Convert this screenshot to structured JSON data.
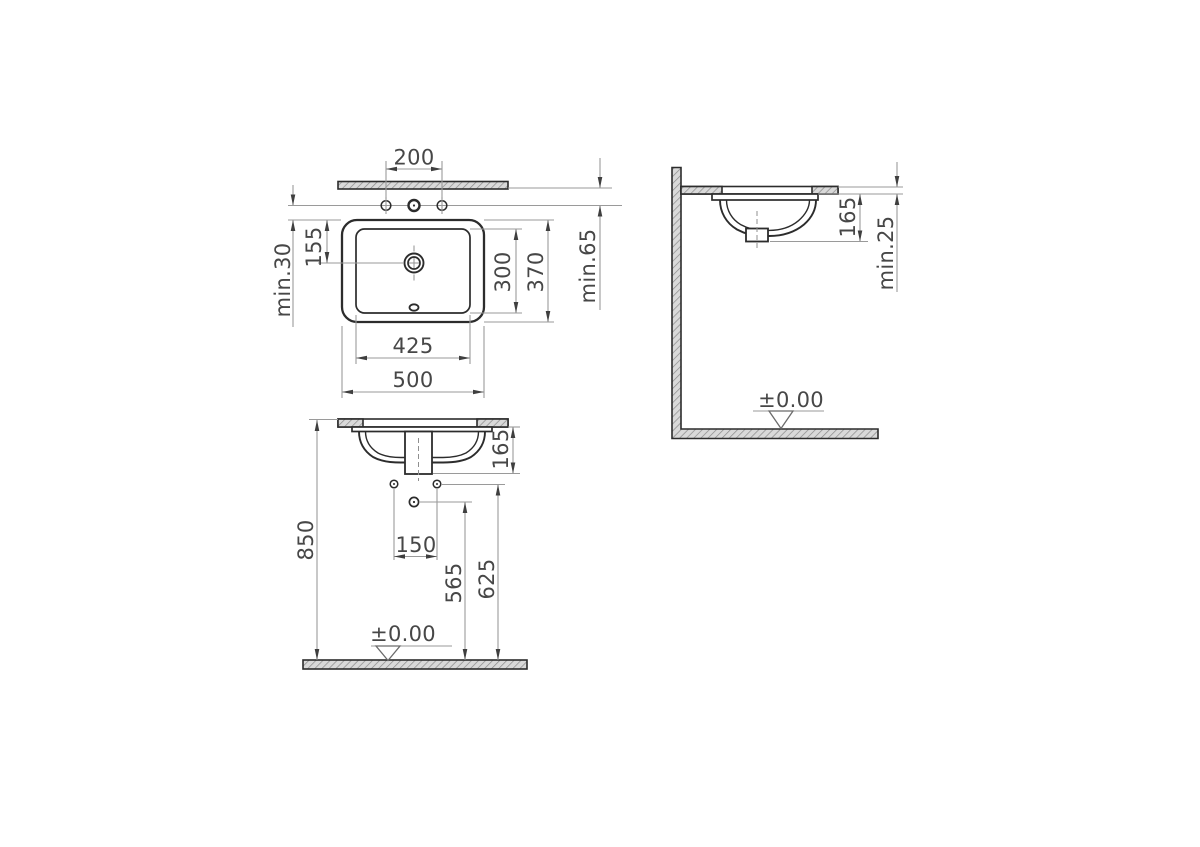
{
  "drawing": {
    "kind": "technical dimension drawing",
    "subject": "undercounter washbasin installation",
    "views": {
      "plan": {
        "dimensions": {
          "tap_hole_spacing": "200",
          "rim_to_drain": "155",
          "holes_to_rim_min": "min.30",
          "bowl_inner_depth": "300",
          "rim_outer_depth": "370",
          "wall_to_holes_min": "min.65",
          "bowl_inner_width": "425",
          "rim_outer_width": "500"
        }
      },
      "front": {
        "dimensions": {
          "bowl_depth": "165",
          "fixing_hole_spacing": "150",
          "waste_outlet_height": "565",
          "fixing_hole_height": "625",
          "counter_top_height": "850",
          "floor_datum": "±0.00"
        }
      },
      "side": {
        "dimensions": {
          "bowl_depth": "165",
          "counter_thickness_min": "min.25",
          "floor_datum": "±0.00"
        }
      }
    },
    "colors": {
      "background": "#ffffff",
      "object_line": "#2c2c2c",
      "dimension_line": "#9a9a9a",
      "arrow": "#3f3f3f",
      "text": "#474747",
      "hatch_fill": "#d9d9d9",
      "hatch_line": "#8a8a8a"
    }
  }
}
